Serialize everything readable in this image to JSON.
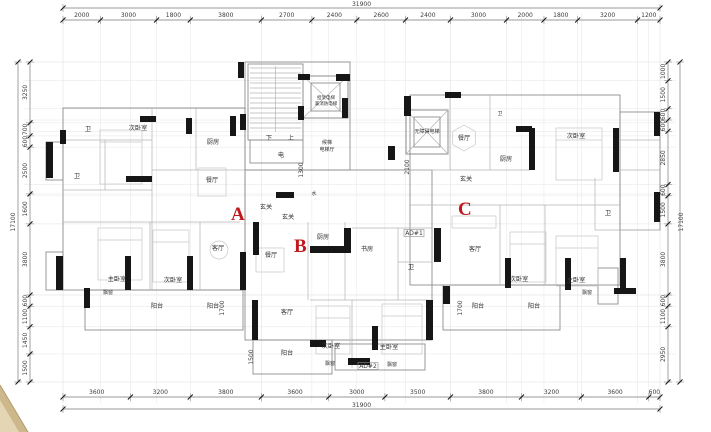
{
  "drawing": {
    "kind": "floor-plan",
    "unit_markers": [
      {
        "label": "A",
        "x": 231,
        "y": 220
      },
      {
        "label": "B",
        "x": 294,
        "y": 252
      },
      {
        "label": "C",
        "x": 458,
        "y": 215
      }
    ],
    "marker_color": "#c0181c"
  },
  "dimensions": {
    "top": {
      "total": "31900",
      "segments": [
        "2000",
        "3000",
        "1800",
        "3800",
        "2700",
        "2400",
        "2600",
        "2400",
        "3000",
        "2000",
        "1800",
        "3200",
        "1200"
      ]
    },
    "bottom": {
      "total": "31900",
      "segments": [
        "3600",
        "3200",
        "3800",
        "3600",
        "3000",
        "3500",
        "3800",
        "3200",
        "3600",
        "600"
      ]
    },
    "left": {
      "total": "17100",
      "segments": [
        "3250",
        "700",
        "600",
        "2500",
        "1600",
        "3800",
        "600",
        "1100",
        "1450",
        "1500"
      ]
    },
    "right": {
      "total": "17100",
      "segments": [
        "1000",
        "1500",
        "600",
        "600",
        "2850",
        "600",
        "1500",
        "3800",
        "600",
        "1100",
        "2950"
      ]
    }
  },
  "room_labels": [
    {
      "text": "卫",
      "x": 88,
      "y": 131
    },
    {
      "text": "卫",
      "x": 77,
      "y": 178
    },
    {
      "text": "次卧室",
      "x": 138,
      "y": 130
    },
    {
      "text": "厨房",
      "x": 213,
      "y": 144
    },
    {
      "text": "餐厅",
      "x": 212,
      "y": 182
    },
    {
      "text": "玄关",
      "x": 266,
      "y": 209
    },
    {
      "text": "玄关",
      "x": 288,
      "y": 219
    },
    {
      "text": "客厅",
      "x": 218,
      "y": 250
    },
    {
      "text": "主卧室",
      "x": 117,
      "y": 281
    },
    {
      "text": "飘窗",
      "x": 108,
      "y": 294,
      "size": 5
    },
    {
      "text": "次卧室",
      "x": 173,
      "y": 282
    },
    {
      "text": "阳台",
      "x": 157,
      "y": 308
    },
    {
      "text": "阳台",
      "x": 213,
      "y": 308
    },
    {
      "text": "下",
      "x": 269,
      "y": 140
    },
    {
      "text": "上",
      "x": 291,
      "y": 140
    },
    {
      "text": "电",
      "x": 281,
      "y": 157
    },
    {
      "text": "担架电梯",
      "x": 326,
      "y": 99,
      "size": 4.5
    },
    {
      "text": "兼消防电梯",
      "x": 326,
      "y": 105,
      "size": 4.5
    },
    {
      "text": "候梯",
      "x": 327,
      "y": 144,
      "size": 5
    },
    {
      "text": "电梯厅",
      "x": 327,
      "y": 151,
      "size": 5
    },
    {
      "text": "水",
      "x": 314,
      "y": 195,
      "size": 5
    },
    {
      "text": "厨房",
      "x": 323,
      "y": 239
    },
    {
      "text": "书房",
      "x": 367,
      "y": 251
    },
    {
      "text": "卫",
      "x": 411,
      "y": 269
    },
    {
      "text": "餐厅",
      "x": 271,
      "y": 257
    },
    {
      "text": "客厅",
      "x": 287,
      "y": 314
    },
    {
      "text": "阳台",
      "x": 287,
      "y": 355
    },
    {
      "text": "次卧室",
      "x": 331,
      "y": 348
    },
    {
      "text": "飘窗",
      "x": 330,
      "y": 365,
      "size": 5
    },
    {
      "text": "主卧室",
      "x": 389,
      "y": 349
    },
    {
      "text": "飘窗",
      "x": 392,
      "y": 366,
      "size": 5
    },
    {
      "text": "无障碍电梯",
      "x": 427,
      "y": 133,
      "size": 5
    },
    {
      "text": "餐厅",
      "x": 464,
      "y": 140
    },
    {
      "text": "玄关",
      "x": 466,
      "y": 181
    },
    {
      "text": "厨房",
      "x": 506,
      "y": 161
    },
    {
      "text": "卫",
      "x": 500,
      "y": 115,
      "size": 5
    },
    {
      "text": "次卧室",
      "x": 576,
      "y": 138
    },
    {
      "text": "卫",
      "x": 608,
      "y": 215
    },
    {
      "text": "客厅",
      "x": 475,
      "y": 251
    },
    {
      "text": "次卧室",
      "x": 519,
      "y": 281
    },
    {
      "text": "主卧室",
      "x": 576,
      "y": 282
    },
    {
      "text": "飘窗",
      "x": 587,
      "y": 294,
      "size": 5
    },
    {
      "text": "阳台",
      "x": 478,
      "y": 308
    },
    {
      "text": "阳台",
      "x": 534,
      "y": 308
    }
  ],
  "duct_labels": [
    {
      "text": "AD#1",
      "x": 414,
      "y": 235
    },
    {
      "text": "AD#2",
      "x": 368,
      "y": 368
    }
  ],
  "internal_dimensions": [
    {
      "text": "1300",
      "x": 303,
      "y": 170
    },
    {
      "text": "2100",
      "x": 409,
      "y": 167
    },
    {
      "text": "1700",
      "x": 224,
      "y": 308
    },
    {
      "text": "1500",
      "x": 253,
      "y": 357
    },
    {
      "text": "1700",
      "x": 462,
      "y": 308
    }
  ],
  "colors": {
    "wall_black": "#161616",
    "line_gray": "#8d8d8d",
    "dim_text": "#3c3c3c",
    "marker_red": "#c0181c",
    "corner_tan": "#cdb88c",
    "corner_tan_light": "#e4d6b4"
  }
}
